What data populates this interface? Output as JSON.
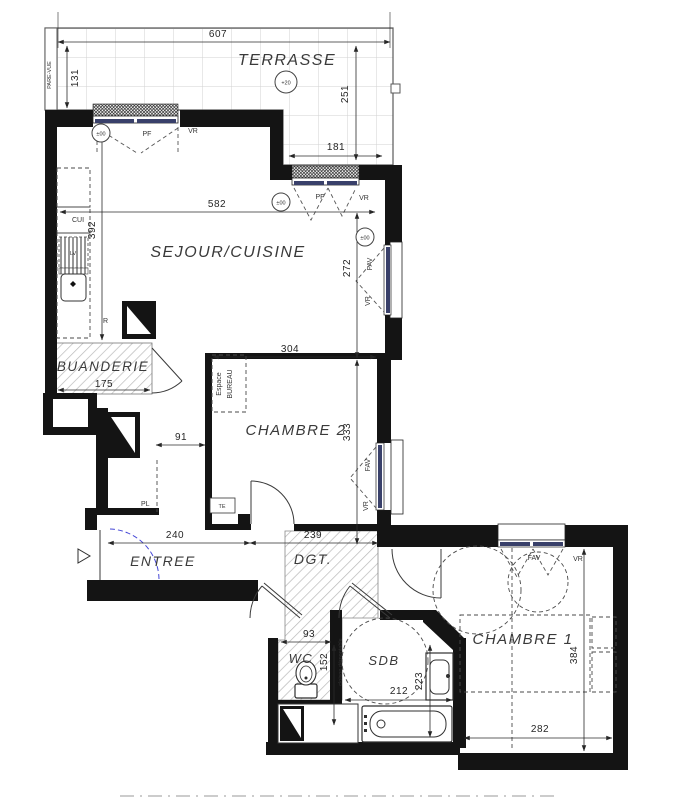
{
  "plan": {
    "rooms": {
      "terrasse": "TERRASSE",
      "sejour": "SEJOUR/CUISINE",
      "buanderie": "BUANDERIE",
      "chambre2": "CHAMBRE 2",
      "entree": "ENTREE",
      "dgt": "DGT.",
      "wc": "WC",
      "sdb": "SDB",
      "chambre1": "CHAMBRE 1"
    },
    "dims": {
      "terrasse_w": "607",
      "terrasse_left_h": "131",
      "terrasse_right_h": "251",
      "terrasse_win_w": "181",
      "sejour_w": "582",
      "sejour_h": "392",
      "sejour_right_h": "272",
      "chambre2_w": "304",
      "chambre2_h": "333",
      "buanderie_w": "175",
      "passage_w": "91",
      "entree_w": "240",
      "dgt_w": "239",
      "wc_w": "93",
      "wc_h": "152",
      "sdb_w": "212",
      "sdb_h": "223",
      "chambre1_h": "384",
      "chambre1_w": "282"
    },
    "annotations": {
      "pare_vue": "PARE-VUE",
      "level_terrasse": "+20",
      "level_zero": "±00",
      "pf": "PF",
      "vr": "VR",
      "fav": "FAV",
      "cui": "CUI",
      "lv": "LV",
      "fridge": "R",
      "placard": "PL",
      "te": "TE",
      "espace_line1": "Espace",
      "espace_line2": "BUREAU",
      "cloison": "cloison démontable"
    },
    "colors": {
      "wall": "#141414",
      "glazing": "#39406a",
      "entry_arc": "#4547d6",
      "hatch": "#b9b9b9",
      "tile_grid": "#d2d2d2"
    }
  }
}
